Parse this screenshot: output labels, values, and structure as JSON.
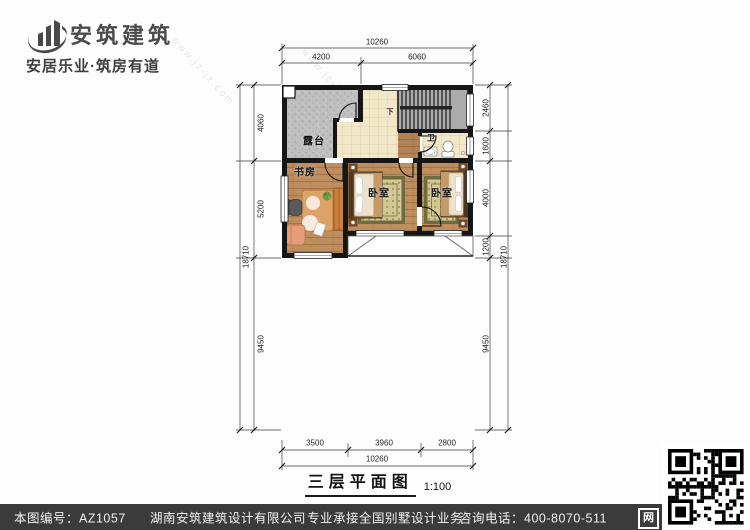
{
  "header": {
    "brand": "安筑建筑",
    "slogan": "安居乐业·筑房有道",
    "brand_color": "#4a4a4a"
  },
  "plan": {
    "title": "三层平面图",
    "scale": "1:100",
    "rooms": {
      "terrace": "露台",
      "study": "书房",
      "bedroom1": "卧室",
      "bedroom2": "卧室",
      "bath": "卫",
      "stair_direction": "下"
    },
    "dimensions": {
      "top_total": "10260",
      "top_segments": [
        "4200",
        "6060"
      ],
      "bottom_segments": [
        "3500",
        "3960",
        "2800"
      ],
      "bottom_total": "10260",
      "left_segments": [
        "4060",
        "5200",
        "9450"
      ],
      "left_overall": "18710",
      "right_segments": [
        "2460",
        "1600",
        "4000",
        "1200",
        "9450"
      ],
      "right_overall": "18710"
    },
    "watermarks": [
      "www.jz-jz.com",
      "安筑建筑"
    ]
  },
  "footer": {
    "drawing_no": "本图编号：AZ1057",
    "company": "湖南安筑建筑设计有限公司",
    "service": "专业承接全国别墅设计业务",
    "phone": "咨询电话：400-8070-511",
    "web_badge": "网",
    "bar_color": "#3b3b3b"
  },
  "palette": {
    "wall": "#161616",
    "wood_floor": "#bd8d5e",
    "tile_floor": "#f2e7c9",
    "terrace_gray": "#bfbfbf",
    "rug_green": "#6c6c40",
    "stair_gray": "#ababab"
  }
}
